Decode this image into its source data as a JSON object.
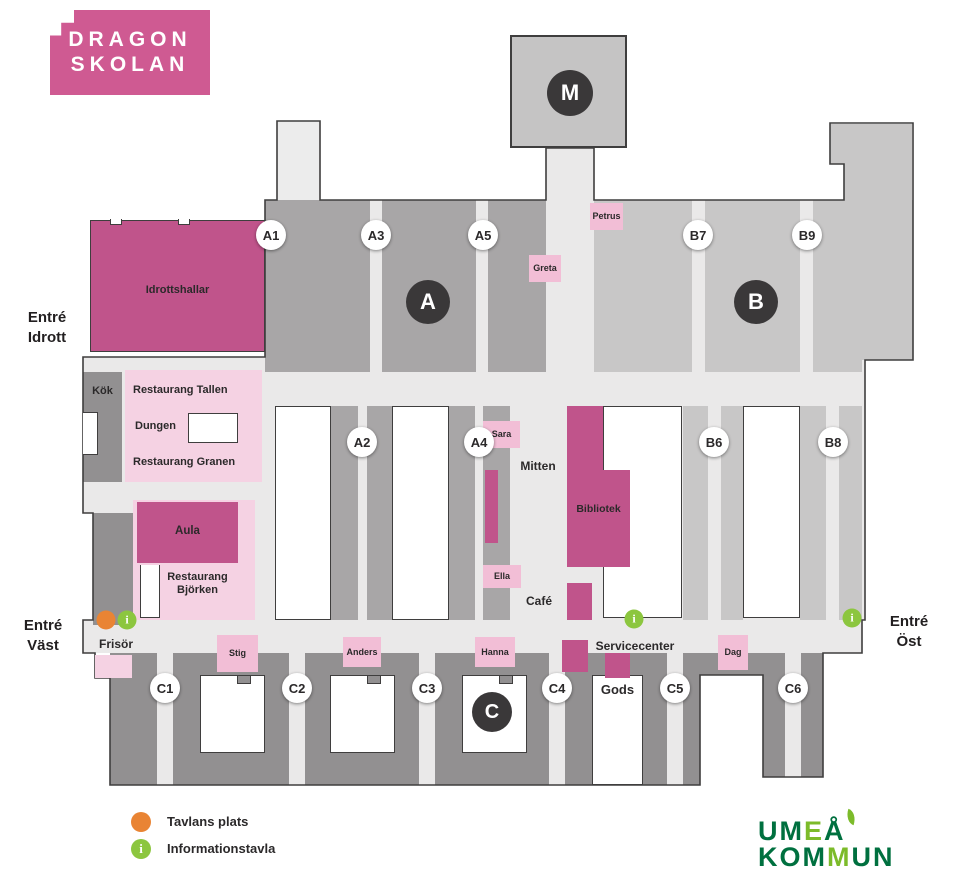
{
  "school_logo": {
    "line1": "DRAGON",
    "line2": "SKOLAN"
  },
  "palette": {
    "brand_pink": "#cf5a92",
    "room_pink_dark": "#c0548b",
    "room_pink_light": "#f5d2e3",
    "label_pink": "#f2bed6",
    "a_wing_gray": "#a8a6a7",
    "b_wing_gray": "#c8c7c7",
    "c_wing_gray": "#929091",
    "corridor_gray": "#eae9e9",
    "badge_dark": "#3a3839",
    "legend_orange": "#e98434",
    "legend_green": "#8cc63f",
    "municipal_green_dark": "#00703f",
    "municipal_green_light": "#7cbb2a"
  },
  "map": {
    "section_badges": {
      "m": "M",
      "a": "A",
      "b": "B",
      "c": "C"
    },
    "corridor_badges": {
      "a1": "A1",
      "a3": "A3",
      "a5": "A5",
      "b7": "B7",
      "b9": "B9",
      "a2": "A2",
      "a4": "A4",
      "b6": "B6",
      "b8": "B8",
      "c1": "C1",
      "c2": "C2",
      "c3": "C3",
      "c4": "C4",
      "c5": "C5",
      "c6": "C6"
    },
    "rooms": {
      "idrottshallar": "Idrottshallar",
      "kok": "Kök",
      "restaurang_tallen": "Restaurang Tallen",
      "dungen": "Dungen",
      "restaurang_granen": "Restaurang Granen",
      "aula": "Aula",
      "restaurang_bjorken": "Restaurang Björken",
      "bibliotek": "Bibliotek",
      "mitten": "Mitten",
      "cafe": "Café",
      "frisor": "Frisör",
      "servicecenter": "Servicecenter",
      "gods": "Gods"
    },
    "name_labels": {
      "petrus": "Petrus",
      "greta": "Greta",
      "sara": "Sara",
      "ella": "Ella",
      "stig": "Stig",
      "anders": "Anders",
      "hanna": "Hanna",
      "dag": "Dag"
    },
    "entrances": {
      "idrott": "Entré Idrott",
      "vast": "Entré Väst",
      "ost": "Entré Öst"
    },
    "info_glyph": "i"
  },
  "legend": {
    "tavlans_plats": "Tavlans plats",
    "informationstavla": "Informationstavla"
  },
  "municipality_logo": {
    "seg1": "UM",
    "seg2": "E",
    "seg3": "Å",
    "seg4": "KOM",
    "seg5": "M",
    "seg6": "UN"
  }
}
